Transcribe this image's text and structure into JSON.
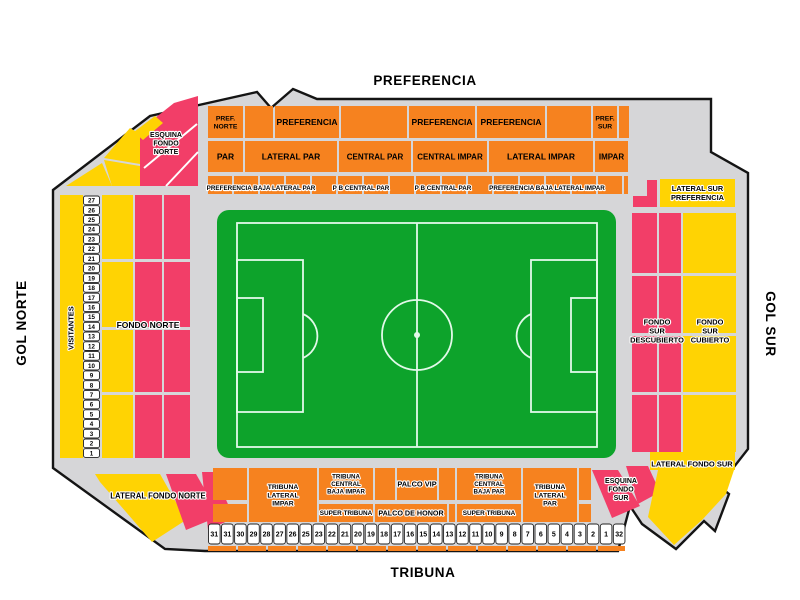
{
  "titles": {
    "top": "PREFERENCIA",
    "bottom": "TRIBUNA",
    "left": "GOL NORTE",
    "right": "GOL SUR"
  },
  "colors": {
    "orange": "#F6821F",
    "yellow": "#FFD303",
    "pink": "#F23E68",
    "gray": "#D6D6D8",
    "outline": "#141414",
    "pitch_green": "#0DA32B",
    "pitch_line": "#E2F9E9"
  },
  "outline_points": "53,190 150,116 257,92 271,108 293,89 317,99 711,99 711,152 748,173 748,449 719,486 729,494 715,531 704,521 676,549 642,524 630,506 618,551 205,551 165,549 53,468",
  "blocks": [
    {
      "n": "sec-pref-norte",
      "x": 208,
      "y": 106,
      "w": 35,
      "h": 32,
      "c": "orange",
      "label": "PREF.\nNORTE",
      "fs": 6.8
    },
    {
      "n": "sec-r1-2",
      "x": 245,
      "y": 106,
      "w": 28,
      "h": 32,
      "c": "orange"
    },
    {
      "n": "sec-preferencia-1",
      "x": 275,
      "y": 106,
      "w": 64,
      "h": 32,
      "c": "orange",
      "label": "PREFERENCIA",
      "fs": 8.5
    },
    {
      "n": "sec-r1-4",
      "x": 341,
      "y": 106,
      "w": 66,
      "h": 32,
      "c": "orange"
    },
    {
      "n": "sec-preferencia-2",
      "x": 409,
      "y": 106,
      "w": 66,
      "h": 32,
      "c": "orange",
      "label": "PREFERENCIA",
      "fs": 8.5
    },
    {
      "n": "sec-preferencia-3",
      "x": 477,
      "y": 106,
      "w": 68,
      "h": 32,
      "c": "orange",
      "label": "PREFERENCIA",
      "fs": 8.5
    },
    {
      "n": "sec-r1-7",
      "x": 547,
      "y": 106,
      "w": 44,
      "h": 32,
      "c": "orange"
    },
    {
      "n": "sec-pref-sur",
      "x": 593,
      "y": 106,
      "w": 24,
      "h": 32,
      "c": "orange",
      "label": "PREF.\nSUR",
      "fs": 6.8
    },
    {
      "n": "sec-r1-9",
      "x": 619,
      "y": 106,
      "w": 10,
      "h": 32,
      "c": "orange"
    },
    {
      "n": "sec-par",
      "x": 208,
      "y": 141,
      "w": 35,
      "h": 31,
      "c": "orange",
      "label": "PAR",
      "fs": 8.5
    },
    {
      "n": "sec-lateral-par",
      "x": 245,
      "y": 141,
      "w": 92,
      "h": 31,
      "c": "orange",
      "label": "LATERAL PAR",
      "fs": 8.5
    },
    {
      "n": "sec-central-par",
      "x": 339,
      "y": 141,
      "w": 72,
      "h": 31,
      "c": "orange",
      "label": "CENTRAL PAR",
      "fs": 8
    },
    {
      "n": "sec-central-impar",
      "x": 413,
      "y": 141,
      "w": 74,
      "h": 31,
      "c": "orange",
      "label": "CENTRAL IMPAR",
      "fs": 8
    },
    {
      "n": "sec-lateral-impar",
      "x": 489,
      "y": 141,
      "w": 104,
      "h": 31,
      "c": "orange",
      "label": "LATERAL IMPAR",
      "fs": 8.5
    },
    {
      "n": "sec-impar",
      "x": 595,
      "y": 141,
      "w": 33,
      "h": 31,
      "c": "orange",
      "label": "IMPAR",
      "fs": 8
    },
    {
      "n": "sec-visitantes",
      "x": 60,
      "y": 195,
      "w": 23,
      "h": 263,
      "c": "yellow"
    },
    {
      "n": "sec-fondo-norte-y1",
      "x": 102,
      "y": 195,
      "w": 31,
      "h": 64,
      "c": "yellow"
    },
    {
      "n": "sec-fondo-norte-y2",
      "x": 102,
      "y": 262,
      "w": 31,
      "h": 65,
      "c": "yellow"
    },
    {
      "n": "sec-fondo-norte-y3",
      "x": 102,
      "y": 330,
      "w": 31,
      "h": 62,
      "c": "yellow"
    },
    {
      "n": "sec-fondo-norte-y4",
      "x": 102,
      "y": 395,
      "w": 31,
      "h": 63,
      "c": "yellow"
    },
    {
      "n": "sec-fondo-norte-p1",
      "x": 135,
      "y": 195,
      "w": 27,
      "h": 64,
      "c": "pink"
    },
    {
      "n": "sec-fondo-norte-p2",
      "x": 135,
      "y": 262,
      "w": 27,
      "h": 65,
      "c": "pink"
    },
    {
      "n": "sec-fondo-norte-p3",
      "x": 135,
      "y": 330,
      "w": 27,
      "h": 62,
      "c": "pink"
    },
    {
      "n": "sec-fondo-norte-p4",
      "x": 135,
      "y": 395,
      "w": 27,
      "h": 63,
      "c": "pink"
    },
    {
      "n": "sec-fondo-norte-p5",
      "x": 164,
      "y": 195,
      "w": 26,
      "h": 64,
      "c": "pink"
    },
    {
      "n": "sec-fondo-norte-p6",
      "x": 164,
      "y": 262,
      "w": 26,
      "h": 65,
      "c": "pink"
    },
    {
      "n": "sec-fondo-norte-p7",
      "x": 164,
      "y": 330,
      "w": 26,
      "h": 62,
      "c": "pink"
    },
    {
      "n": "sec-fondo-norte-p8",
      "x": 164,
      "y": 395,
      "w": 26,
      "h": 63,
      "c": "pink"
    },
    {
      "n": "sec-fondo-sur-p1",
      "x": 632,
      "y": 213,
      "w": 25,
      "h": 60,
      "c": "pink"
    },
    {
      "n": "sec-fondo-sur-p2",
      "x": 632,
      "y": 276,
      "w": 25,
      "h": 57,
      "c": "pink"
    },
    {
      "n": "sec-fondo-sur-p3",
      "x": 632,
      "y": 336,
      "w": 25,
      "h": 56,
      "c": "pink"
    },
    {
      "n": "sec-fondo-sur-p4",
      "x": 632,
      "y": 395,
      "w": 25,
      "h": 57,
      "c": "pink"
    },
    {
      "n": "sec-fondo-sur-p5",
      "x": 659,
      "y": 213,
      "w": 22,
      "h": 60,
      "c": "pink"
    },
    {
      "n": "sec-fondo-sur-p6",
      "x": 659,
      "y": 276,
      "w": 22,
      "h": 57,
      "c": "pink"
    },
    {
      "n": "sec-fondo-sur-p7",
      "x": 659,
      "y": 336,
      "w": 22,
      "h": 56,
      "c": "pink"
    },
    {
      "n": "sec-fondo-sur-p8",
      "x": 659,
      "y": 395,
      "w": 22,
      "h": 57,
      "c": "pink"
    },
    {
      "n": "sec-fondo-sur-c1",
      "x": 683,
      "y": 213,
      "w": 53,
      "h": 60,
      "c": "yellow"
    },
    {
      "n": "sec-fondo-sur-c2",
      "x": 683,
      "y": 276,
      "w": 53,
      "h": 57,
      "c": "yellow"
    },
    {
      "n": "sec-fondo-sur-c3",
      "x": 683,
      "y": 336,
      "w": 53,
      "h": 56,
      "c": "yellow"
    },
    {
      "n": "sec-fondo-sur-c4",
      "x": 683,
      "y": 395,
      "w": 53,
      "h": 57,
      "c": "yellow"
    },
    {
      "n": "sec-lateral-sur-preferencia",
      "x": 660,
      "y": 179,
      "w": 75,
      "h": 28,
      "c": "yellow",
      "label": "LATERAL SUR\nPREFERENCIA",
      "fs": 7.4,
      "hl": 1
    },
    {
      "n": "sec-lateral-fondo-sur-strip",
      "x": 650,
      "y": 452,
      "w": 85,
      "h": 18,
      "c": "yellow"
    },
    {
      "n": "sec-ba-1",
      "x": 213,
      "y": 468,
      "w": 34,
      "h": 32,
      "c": "orange"
    },
    {
      "n": "sec-tribuna-lateral-impar",
      "x": 249,
      "y": 468,
      "w": 68,
      "h": 54,
      "c": "orange",
      "label": "TRIBUNA\nLATERAL\nIMPAR",
      "fs": 6.8,
      "hl": 1
    },
    {
      "n": "sec-tribuna-central-baja-impar",
      "x": 319,
      "y": 468,
      "w": 54,
      "h": 32,
      "c": "orange",
      "label": "TRIBUNA\nCENTRAL\nBAJA IMPAR",
      "fs": 6.2,
      "hl": 1
    },
    {
      "n": "sec-ba-4",
      "x": 375,
      "y": 468,
      "w": 20,
      "h": 32,
      "c": "orange"
    },
    {
      "n": "sec-palco-vip",
      "x": 397,
      "y": 468,
      "w": 40,
      "h": 32,
      "c": "orange",
      "label": "PALCO VIP",
      "fs": 7.4,
      "hl": 1
    },
    {
      "n": "sec-ba-6",
      "x": 439,
      "y": 468,
      "w": 16,
      "h": 32,
      "c": "orange"
    },
    {
      "n": "sec-tribuna-central-baja-par",
      "x": 457,
      "y": 468,
      "w": 64,
      "h": 32,
      "c": "orange",
      "label": "TRIBUNA\nCENTRAL\nBAJA PAR",
      "fs": 6.2,
      "hl": 1
    },
    {
      "n": "sec-tribuna-lateral-par",
      "x": 523,
      "y": 468,
      "w": 54,
      "h": 54,
      "c": "orange",
      "label": "TRIBUNA\nLATERAL\nPAR",
      "fs": 6.8,
      "hl": 1
    },
    {
      "n": "sec-ba-9",
      "x": 579,
      "y": 468,
      "w": 12,
      "h": 32,
      "c": "orange"
    },
    {
      "n": "sec-bb-1",
      "x": 213,
      "y": 504,
      "w": 34,
      "h": 18,
      "c": "orange"
    },
    {
      "n": "sec-super-tribuna-impar",
      "x": 319,
      "y": 504,
      "w": 54,
      "h": 18,
      "c": "orange",
      "label": "SUPER TRIBUNA",
      "fs": 6.4,
      "hl": 1
    },
    {
      "n": "sec-palco-de-honor",
      "x": 375,
      "y": 504,
      "w": 72,
      "h": 18,
      "c": "orange",
      "label": "PALCO DE HONOR",
      "fs": 7.2,
      "hl": 1
    },
    {
      "n": "sec-bb-4",
      "x": 449,
      "y": 504,
      "w": 6,
      "h": 18,
      "c": "orange"
    },
    {
      "n": "sec-super-tribuna-par",
      "x": 457,
      "y": 504,
      "w": 64,
      "h": 18,
      "c": "orange",
      "label": "SUPER TRIBUNA",
      "fs": 6.4,
      "hl": 1
    },
    {
      "n": "sec-bb-6",
      "x": 579,
      "y": 504,
      "w": 12,
      "h": 18,
      "c": "orange"
    }
  ],
  "wedges": [
    {
      "n": "sec-bl-pink-2",
      "c": "pink",
      "pts": "202,472 214,472 234,518 208,530"
    },
    {
      "n": "sec-esquina-fondo-norte",
      "c": "pink",
      "pts": "140,130 174,103 198,96 198,186 140,186"
    },
    {
      "n": "sec-tl-yellow-1",
      "c": "yellow",
      "pts": "104,158 130,128 140,134 140,164"
    },
    {
      "n": "sec-tl-yellow-2",
      "c": "yellow",
      "pts": "134,132 155,116 163,123 143,140"
    },
    {
      "n": "sec-tl-yellow-3",
      "c": "yellow",
      "pts": "104,160 140,166 140,186 112,186"
    },
    {
      "n": "sec-tl-yellow-4",
      "c": "yellow",
      "pts": "66,186 102,163 112,186"
    },
    {
      "n": "sec-bl-yellow",
      "c": "yellow",
      "pts": "95,474 160,474 186,520 152,542 100,482"
    },
    {
      "n": "sec-bl-pink-1",
      "c": "pink",
      "pts": "166,474 196,474 220,516 186,530"
    },
    {
      "n": "sec-br-pink-1",
      "c": "pink",
      "pts": "592,470 618,470 640,506 612,518"
    },
    {
      "n": "sec-br-pink-2",
      "c": "pink",
      "pts": "626,466 648,466 660,492 638,504"
    },
    {
      "n": "sec-br-yellow",
      "c": "yellow",
      "pts": "658,470 734,470 726,494 702,520 674,545 648,517"
    },
    {
      "n": "sec-tr-pink-l",
      "c": "pink",
      "pts": "647,180 657,180 657,207 633,207 633,196 647,196"
    }
  ],
  "deco_lines": [
    {
      "x1": 144,
      "y1": 168,
      "x2": 197,
      "y2": 124
    },
    {
      "x1": 166,
      "y1": 186,
      "x2": 198,
      "y2": 152
    }
  ],
  "strip_rows": [
    {
      "n": "strip-preferencia-baja",
      "x0": 208,
      "x1": 628,
      "y": 176,
      "h": 18,
      "seg": 24,
      "gap": 2,
      "c": "orange"
    },
    {
      "n": "strip-tribuna-baja",
      "x0": 208,
      "x1": 625,
      "y": 546,
      "h": 5,
      "seg": 28,
      "gap": 2,
      "c": "orange"
    }
  ],
  "labels": [
    {
      "n": "label-pref-baja-lateral-par",
      "t": "PREFERENCIA BAJA LATERAL PAR",
      "x": 261,
      "y": 188,
      "fs": 6.3,
      "hl": 1
    },
    {
      "n": "label-pb-central-par-1",
      "t": "P B CENTRAL PAR",
      "x": 361,
      "y": 188,
      "fs": 6.3,
      "hl": 1
    },
    {
      "n": "label-pb-central-par-2",
      "t": "P B CENTRAL PAR",
      "x": 443,
      "y": 188,
      "fs": 6.3,
      "hl": 1
    },
    {
      "n": "label-pref-baja-lateral-impar",
      "t": "PREFERENCIA BAJA LATERAL IMPAR",
      "x": 547,
      "y": 188,
      "fs": 6.3,
      "hl": 1
    },
    {
      "n": "label-esquina-fondo-norte",
      "t": "ESQUINA\nFONDO\nNORTE",
      "x": 166,
      "y": 143,
      "fs": 7,
      "hl": 1
    },
    {
      "n": "label-visitantes",
      "t": "VISITANTES",
      "x": 71,
      "y": 328,
      "fs": 7.5,
      "hl": 1,
      "rot": -90
    },
    {
      "n": "label-fondo-norte",
      "t": "FONDO NORTE",
      "x": 148,
      "y": 325,
      "fs": 8.5,
      "hl": 1
    },
    {
      "n": "label-fondo-sur-descubierto",
      "t": "FONDO\nSUR\nDESCUBIERTO",
      "x": 657,
      "y": 331,
      "fs": 7.4,
      "hl": 1
    },
    {
      "n": "label-fondo-sur-cubierto",
      "t": "FONDO\nSUR\nCUBIERTO",
      "x": 710,
      "y": 331,
      "fs": 7.4,
      "hl": 1
    },
    {
      "n": "label-lateral-sur-preferencia-none",
      "t": "",
      "x": 0,
      "y": 0,
      "fs": 1
    },
    {
      "n": "label-lateral-fondo-norte",
      "t": "LATERAL FONDO NORTE",
      "x": 158,
      "y": 496,
      "fs": 7.8,
      "hl": 1
    },
    {
      "n": "label-lateral-fondo-sur",
      "t": "LATERAL FONDO SUR",
      "x": 692,
      "y": 464,
      "fs": 7.5,
      "hl": 1
    },
    {
      "n": "label-esquina-fondo-sur",
      "t": "ESQUINA\nFONDO\nSUR",
      "x": 621,
      "y": 489,
      "fs": 7,
      "hl": 1
    }
  ],
  "numbers_left": {
    "x": 83.5,
    "w": 16,
    "h": 8.7,
    "y0": 196,
    "step": 9.72,
    "fs": 6.2,
    "values": [
      27,
      26,
      25,
      24,
      23,
      22,
      21,
      20,
      19,
      18,
      17,
      16,
      15,
      14,
      13,
      12,
      11,
      10,
      9,
      8,
      7,
      6,
      5,
      4,
      3,
      2,
      1
    ]
  },
  "numbers_bottom": {
    "y": 524,
    "h": 20,
    "w": 11.6,
    "x0": 208.5,
    "step": 13.06,
    "fs": 7,
    "values": [
      31,
      31,
      30,
      29,
      28,
      27,
      26,
      25,
      23,
      22,
      21,
      20,
      19,
      18,
      17,
      16,
      15,
      14,
      13,
      12,
      11,
      10,
      9,
      8,
      7,
      6,
      5,
      4,
      3,
      2,
      1,
      32
    ]
  }
}
